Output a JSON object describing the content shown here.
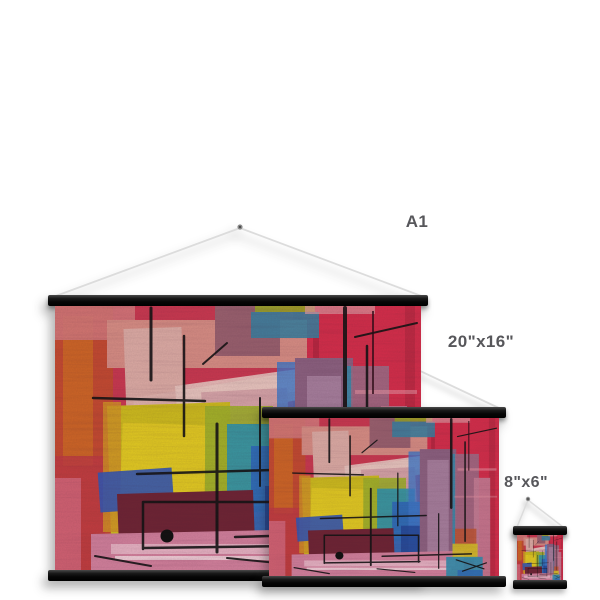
{
  "image": {
    "background_color": "#ffffff",
    "description": "Size comparison of three hanging wall-art prints on black poster hangers"
  },
  "prints": [
    {
      "id": "large",
      "size_label": "A1"
    },
    {
      "id": "medium",
      "size_label": "20\"x16\""
    },
    {
      "id": "small",
      "size_label": "8\"x6\""
    }
  ],
  "label_color": "#57575b",
  "hanger": {
    "bar_color": "#0d0d0d",
    "string_color": "#dcdcdc",
    "nail_color": "#8c8c8c"
  },
  "artwork": {
    "style": "abstract acrylic painting",
    "palette": [
      "#d42e4a",
      "#c44a30",
      "#d06a24",
      "#d78d84",
      "#dfb2ac",
      "#e4cc22",
      "#9fb02a",
      "#2f93ac",
      "#2e6ab8",
      "#8c6180",
      "#c57d95",
      "#6e2434",
      "#d2809c",
      "#131313"
    ]
  }
}
